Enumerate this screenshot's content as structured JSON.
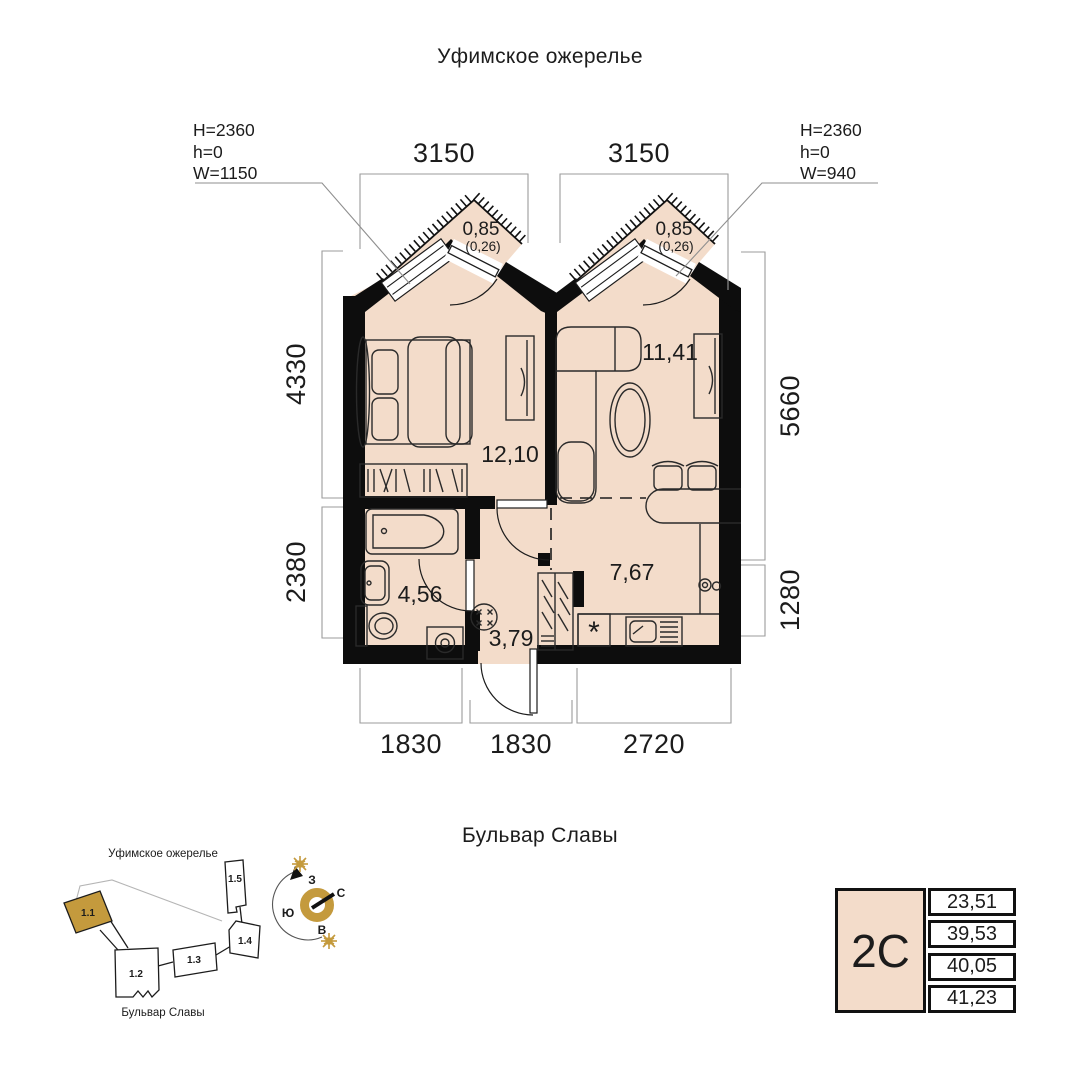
{
  "title": "Уфимское ожерелье",
  "street": "Бульвар Славы",
  "window_specs": {
    "left": {
      "h_total": "H=2360",
      "h_sill": "h=0",
      "width": "W=1150"
    },
    "right": {
      "h_total": "H=2360",
      "h_sill": "h=0",
      "width": "W=940"
    }
  },
  "dimensions": {
    "top": [
      "3150",
      "3150"
    ],
    "left": [
      "4330",
      "2380"
    ],
    "right": [
      "5660",
      "1280"
    ],
    "bottom": [
      "1830",
      "1830",
      "2720"
    ]
  },
  "rooms": {
    "bedroom": "12,10",
    "living": "11,41",
    "kitchen": "7,67",
    "bathroom": "4,56",
    "hall": "3,79"
  },
  "kitchen_marker": "*",
  "balconies": {
    "left": {
      "area": "0,85",
      "reduced": "(0,26)"
    },
    "right": {
      "area": "0,85",
      "reduced": "(0,26)"
    }
  },
  "sitemap": {
    "title": "Уфимское ожерелье",
    "street": "Бульвар Славы",
    "buildings": [
      "1.1",
      "1.2",
      "1.3",
      "1.4",
      "1.5"
    ],
    "compass": {
      "north": "С",
      "south": "Ю",
      "west": "З",
      "east": "В"
    }
  },
  "card": {
    "plan_type": "2С",
    "values": [
      "23,51",
      "39,53",
      "40,05",
      "41,23"
    ]
  },
  "colors": {
    "floor": "#f3dcca",
    "accent": "#c49a3d",
    "wall": "#0d0d0d",
    "dim_line": "#9b9b9b"
  }
}
